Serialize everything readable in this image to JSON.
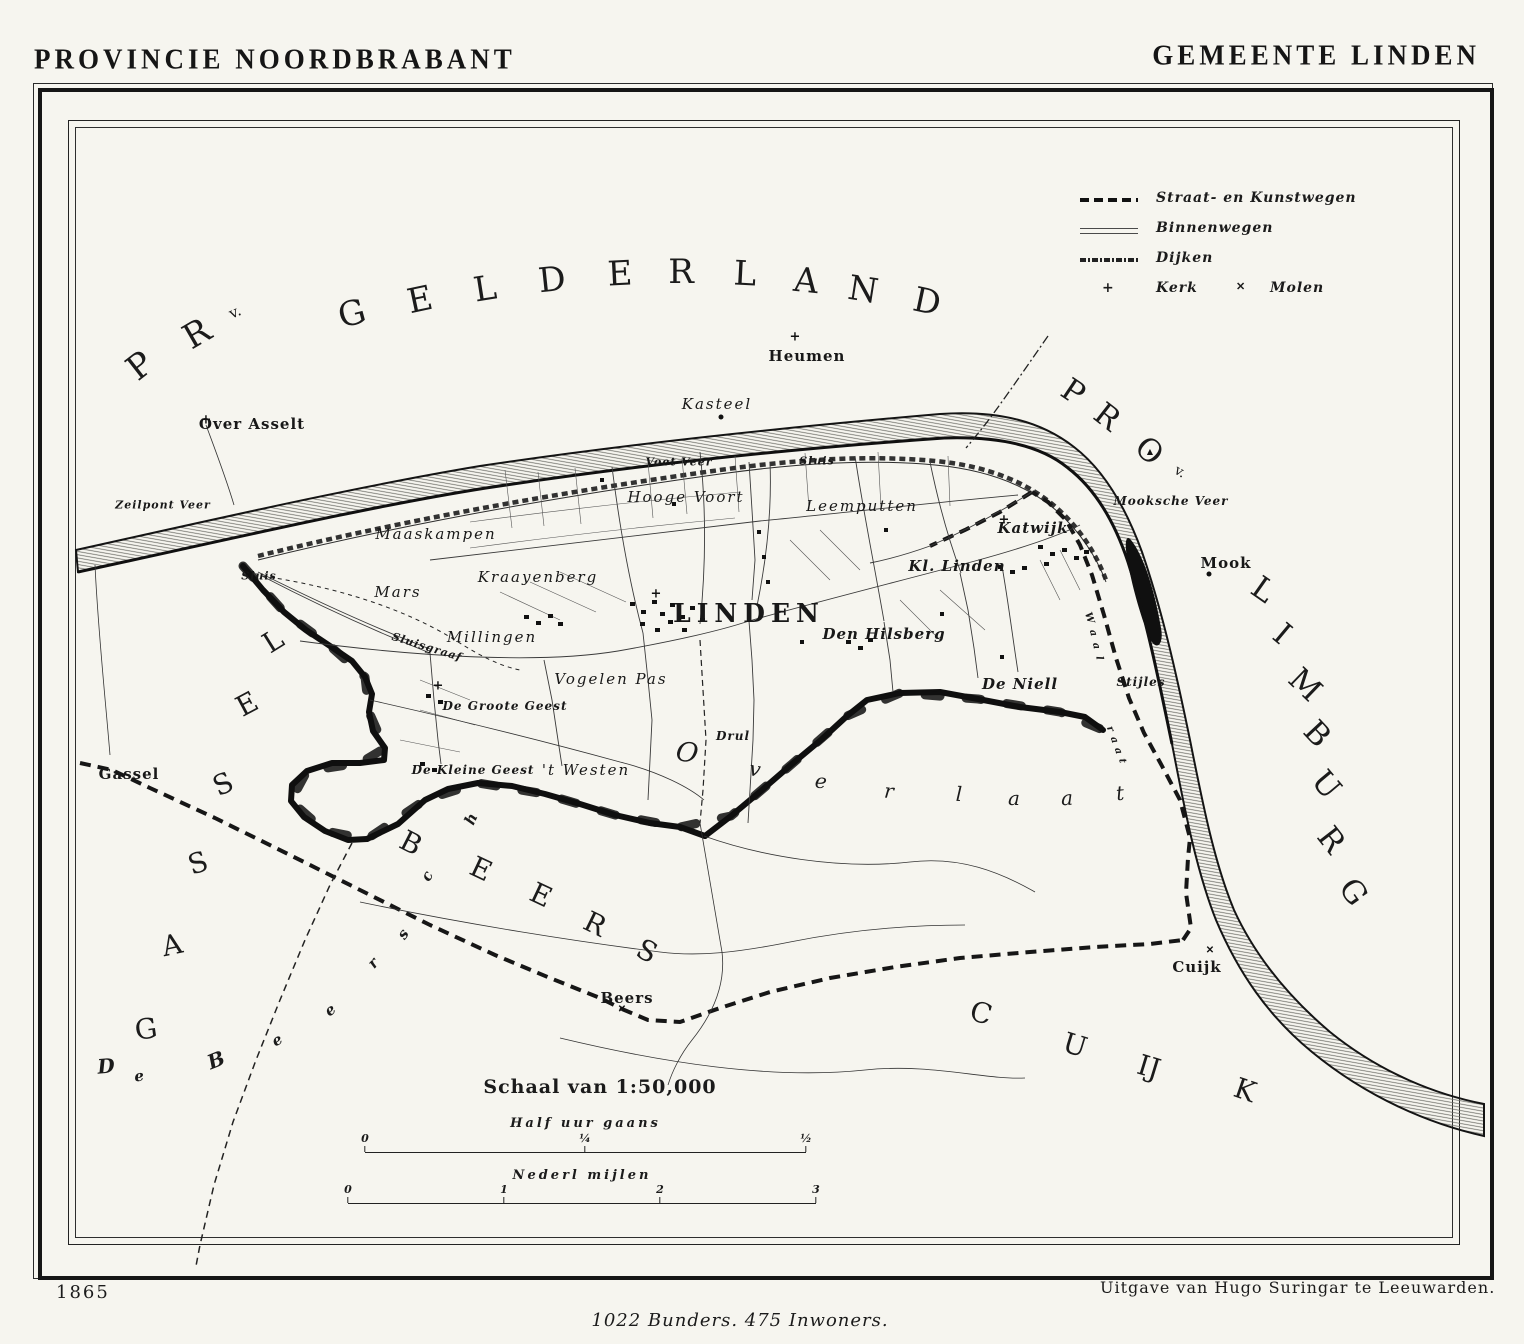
{
  "header": {
    "left": "PROVINCIE NOORDBRABANT",
    "right": "GEMEENTE LINDEN"
  },
  "legend": {
    "rows": [
      {
        "label": "Straat- en Kunstwegen"
      },
      {
        "label": "Binnenwegen"
      },
      {
        "label": "Dijken"
      },
      {
        "label": "Kerk"
      }
    ],
    "molen": "Molen"
  },
  "map": {
    "labels": [
      [
        "Heumen",
        807,
        356,
        "village"
      ],
      [
        "Over Asselt",
        252,
        424,
        "village"
      ],
      [
        "Kasteel",
        717,
        404,
        "field"
      ],
      [
        "Zeilpont Veer",
        163,
        505,
        "small"
      ],
      [
        "Voet Veer",
        679,
        462,
        "small"
      ],
      [
        "Sluis",
        817,
        461,
        "small"
      ],
      [
        "Sluis",
        259,
        576,
        "small"
      ],
      [
        "Maaskampen",
        436,
        534,
        "field"
      ],
      [
        "Kraayenberg",
        538,
        577,
        "field"
      ],
      [
        "Mars",
        398,
        592,
        "field"
      ],
      [
        "Hooge Voort",
        686,
        497,
        "field"
      ],
      [
        "Leemputten",
        862,
        506,
        "field"
      ],
      [
        "Katwijk",
        1033,
        528,
        "field-b"
      ],
      [
        "Kl. Linden",
        957,
        566,
        "field-b"
      ],
      [
        "Mooksche Veer",
        1171,
        501,
        "field-sm"
      ],
      [
        "Mook",
        1226,
        563,
        "village"
      ],
      [
        "LINDEN",
        749,
        613,
        "town"
      ],
      [
        "Millingen",
        492,
        637,
        "field"
      ],
      [
        "Den Hilsberg",
        884,
        634,
        "field-b"
      ],
      [
        "Vogelen Pas",
        611,
        679,
        "field"
      ],
      [
        "De Groote Geest",
        505,
        706,
        "field-sm"
      ],
      [
        "De Niell",
        1020,
        684,
        "field-b"
      ],
      [
        "Stijles",
        1141,
        682,
        "field-sm"
      ],
      [
        "Drul",
        733,
        736,
        "field-sm"
      ],
      [
        "De Kleine Geest",
        473,
        770,
        "field-sm"
      ],
      [
        "'t Westen",
        586,
        770,
        "field"
      ],
      [
        "Gassel",
        129,
        774,
        "village"
      ],
      [
        "Beers",
        627,
        998,
        "village"
      ],
      [
        "Cuijk",
        1197,
        967,
        "village"
      ],
      [
        "Sluisgraaf",
        427,
        647,
        "small",
        17
      ]
    ],
    "spread": [
      {
        "name": "province-gelderland",
        "cls": "sp-prov",
        "letters": [
          [
            "P",
            140,
            366,
            -38
          ],
          [
            "R",
            197,
            334,
            -30
          ],
          [
            "v.",
            235,
            312,
            -24,
            15
          ],
          [
            "G",
            352,
            314,
            -15
          ],
          [
            "E",
            420,
            300,
            -12
          ],
          [
            "L",
            485,
            289,
            -9
          ],
          [
            "D",
            552,
            280,
            -6
          ],
          [
            "E",
            620,
            274,
            -3
          ],
          [
            "R",
            681,
            272,
            0
          ],
          [
            "L",
            745,
            274,
            3
          ],
          [
            "A",
            806,
            281,
            6
          ],
          [
            "N",
            863,
            290,
            9
          ],
          [
            "D",
            927,
            302,
            12
          ]
        ]
      },
      {
        "name": "province-limburg-pro",
        "cls": "sp-prov2",
        "letters": [
          [
            "P",
            1073,
            392,
            34
          ],
          [
            "R",
            1107,
            417,
            38
          ],
          [
            "O",
            1149,
            451,
            42
          ],
          [
            "v.",
            1180,
            472,
            30,
            14
          ]
        ]
      },
      {
        "name": "province-limburg",
        "cls": "sp-prov2",
        "letters": [
          [
            "L",
            1263,
            590,
            35
          ],
          [
            "I",
            1282,
            634,
            40
          ],
          [
            "M",
            1305,
            685,
            44
          ],
          [
            "B",
            1317,
            734,
            47
          ],
          [
            "U",
            1326,
            785,
            50
          ],
          [
            "R",
            1331,
            840,
            52
          ],
          [
            "G",
            1353,
            892,
            55
          ]
        ]
      },
      {
        "name": "municipality-gassel",
        "cls": "sp-muni",
        "letters": [
          [
            "G",
            146,
            1029,
            -8
          ],
          [
            "A",
            172,
            945,
            -12
          ],
          [
            "S",
            198,
            863,
            -18
          ],
          [
            "S",
            223,
            784,
            -24
          ],
          [
            "E",
            247,
            704,
            -28
          ],
          [
            "L",
            273,
            641,
            -32
          ]
        ]
      },
      {
        "name": "municipality-beers",
        "cls": "sp-muni",
        "letters": [
          [
            "B",
            411,
            843,
            27
          ],
          [
            "E",
            481,
            869,
            25
          ],
          [
            "E",
            541,
            895,
            25
          ],
          [
            "R",
            595,
            924,
            26
          ],
          [
            "S",
            647,
            951,
            27
          ]
        ]
      },
      {
        "name": "municipality-cuijk",
        "cls": "sp-muni",
        "letters": [
          [
            "C",
            981,
            1013,
            16
          ],
          [
            "U",
            1075,
            1045,
            17
          ],
          [
            "IJ",
            1149,
            1067,
            17
          ],
          [
            "K",
            1245,
            1090,
            19
          ]
        ]
      },
      {
        "name": "de-beersche",
        "cls": "sp-it",
        "letters": [
          [
            "D",
            106,
            1066,
            -5,
            20
          ],
          [
            "e",
            139,
            1076,
            -8
          ],
          [
            "B",
            216,
            1060,
            -22,
            20
          ],
          [
            "e",
            277,
            1040,
            -30
          ],
          [
            "e",
            330,
            1010,
            -38
          ],
          [
            "r",
            373,
            963,
            -48
          ],
          [
            "s",
            403,
            934,
            -55
          ],
          [
            "c",
            427,
            876,
            -62
          ],
          [
            "h",
            471,
            819,
            -66
          ]
        ]
      },
      {
        "name": "overlaat",
        "cls": "sp-ovl",
        "letters": [
          [
            "O",
            687,
            753,
            10,
            27
          ],
          [
            "v",
            755,
            769,
            9
          ],
          [
            "e",
            821,
            781,
            7
          ],
          [
            "r",
            889,
            791,
            5
          ],
          [
            "l",
            959,
            794,
            2
          ],
          [
            "a",
            1014,
            798,
            0
          ],
          [
            "a",
            1067,
            798,
            -3
          ],
          [
            "t",
            1120,
            793,
            -6
          ]
        ]
      },
      {
        "name": "waal-upper",
        "cls": "sp-tiny",
        "letters": [
          [
            "W",
            1089,
            618,
            72
          ],
          [
            "a",
            1093,
            633,
            76
          ],
          [
            "a",
            1096,
            646,
            79
          ],
          [
            "l",
            1099,
            658,
            82
          ]
        ]
      },
      {
        "name": "waal-lower",
        "cls": "sp-tiny",
        "letters": [
          [
            "r",
            1110,
            729,
            68
          ],
          [
            "a",
            1114,
            740,
            72
          ],
          [
            "a",
            1118,
            751,
            75
          ],
          [
            "t",
            1122,
            761,
            78
          ]
        ]
      }
    ],
    "symbols": [
      [
        "church-cross",
        206,
        420
      ],
      [
        "church-cross",
        795,
        337
      ],
      [
        "church-cross",
        1004,
        520
      ],
      [
        "church-cross",
        438,
        686
      ],
      [
        "church-cross",
        656,
        594
      ],
      [
        "dot",
        1209,
        574
      ],
      [
        "dot",
        721,
        417
      ],
      [
        "triangle",
        1150,
        452
      ],
      [
        "windmill",
        622,
        1010
      ],
      [
        "windmill",
        1210,
        951
      ]
    ]
  },
  "scale": {
    "title": "Schaal van 1:50,000",
    "bars": [
      {
        "label": "Half uur gaans",
        "x1": 365,
        "x2": 806,
        "y": 1152,
        "labely": 1116,
        "ticks": [
          {
            "t": "0",
            "x": 365
          },
          {
            "t": "¼",
            "x": 585
          },
          {
            "t": "½",
            "x": 806
          }
        ]
      },
      {
        "label": "Nederl mijlen",
        "x1": 348,
        "x2": 816,
        "y": 1203,
        "labely": 1168,
        "ticks": [
          {
            "t": "0",
            "x": 348
          },
          {
            "t": "1",
            "x": 504
          },
          {
            "t": "2",
            "x": 660
          },
          {
            "t": "3",
            "x": 816
          }
        ]
      }
    ]
  },
  "footer": {
    "year": "1865",
    "publisher": "Uitgave van Hugo Suringar te Leeuwarden.",
    "stats": "1022 Bunders. 475 Inwoners."
  }
}
